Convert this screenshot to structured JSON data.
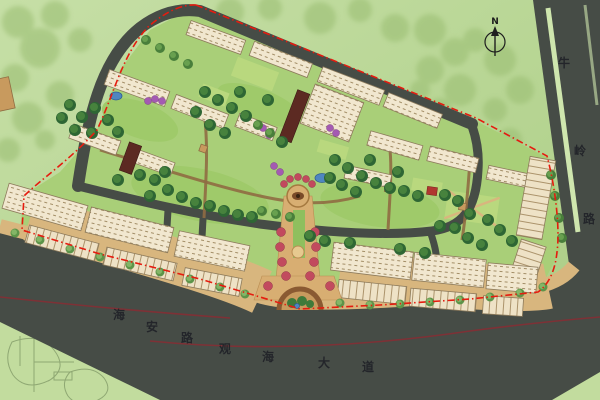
{
  "north": {
    "label": "N"
  },
  "roads": {
    "right": {
      "name": "牛岭路",
      "chars": [
        "牛",
        "岭",
        "路"
      ]
    },
    "bottom": {
      "name": "海安路 观海大道",
      "chars": [
        "海",
        "安",
        "路",
        "观",
        "海",
        "大",
        "道"
      ]
    }
  },
  "palette": {
    "background_green": "#b7d593",
    "tree_mass_green": "#9cbf74",
    "road_gray": "#464c46",
    "road_marking_maroon": "#7e3136",
    "boundary_red": "#e51c0f",
    "building_cream": "#f1e7cf",
    "building_outline": "#8d7b5c",
    "paving_tan": "#d8b67e",
    "plaza_tan": "#d8ae72",
    "lawn_green": "#9fca6a",
    "canopy_dark_green": "#2e6634",
    "flower_purple": "#a45ab2",
    "flower_red": "#c24a5e",
    "water_blue": "#4f86c0",
    "accent_maroon": "#5c2a22",
    "median_stripe_green": "#cfe6ae"
  }
}
